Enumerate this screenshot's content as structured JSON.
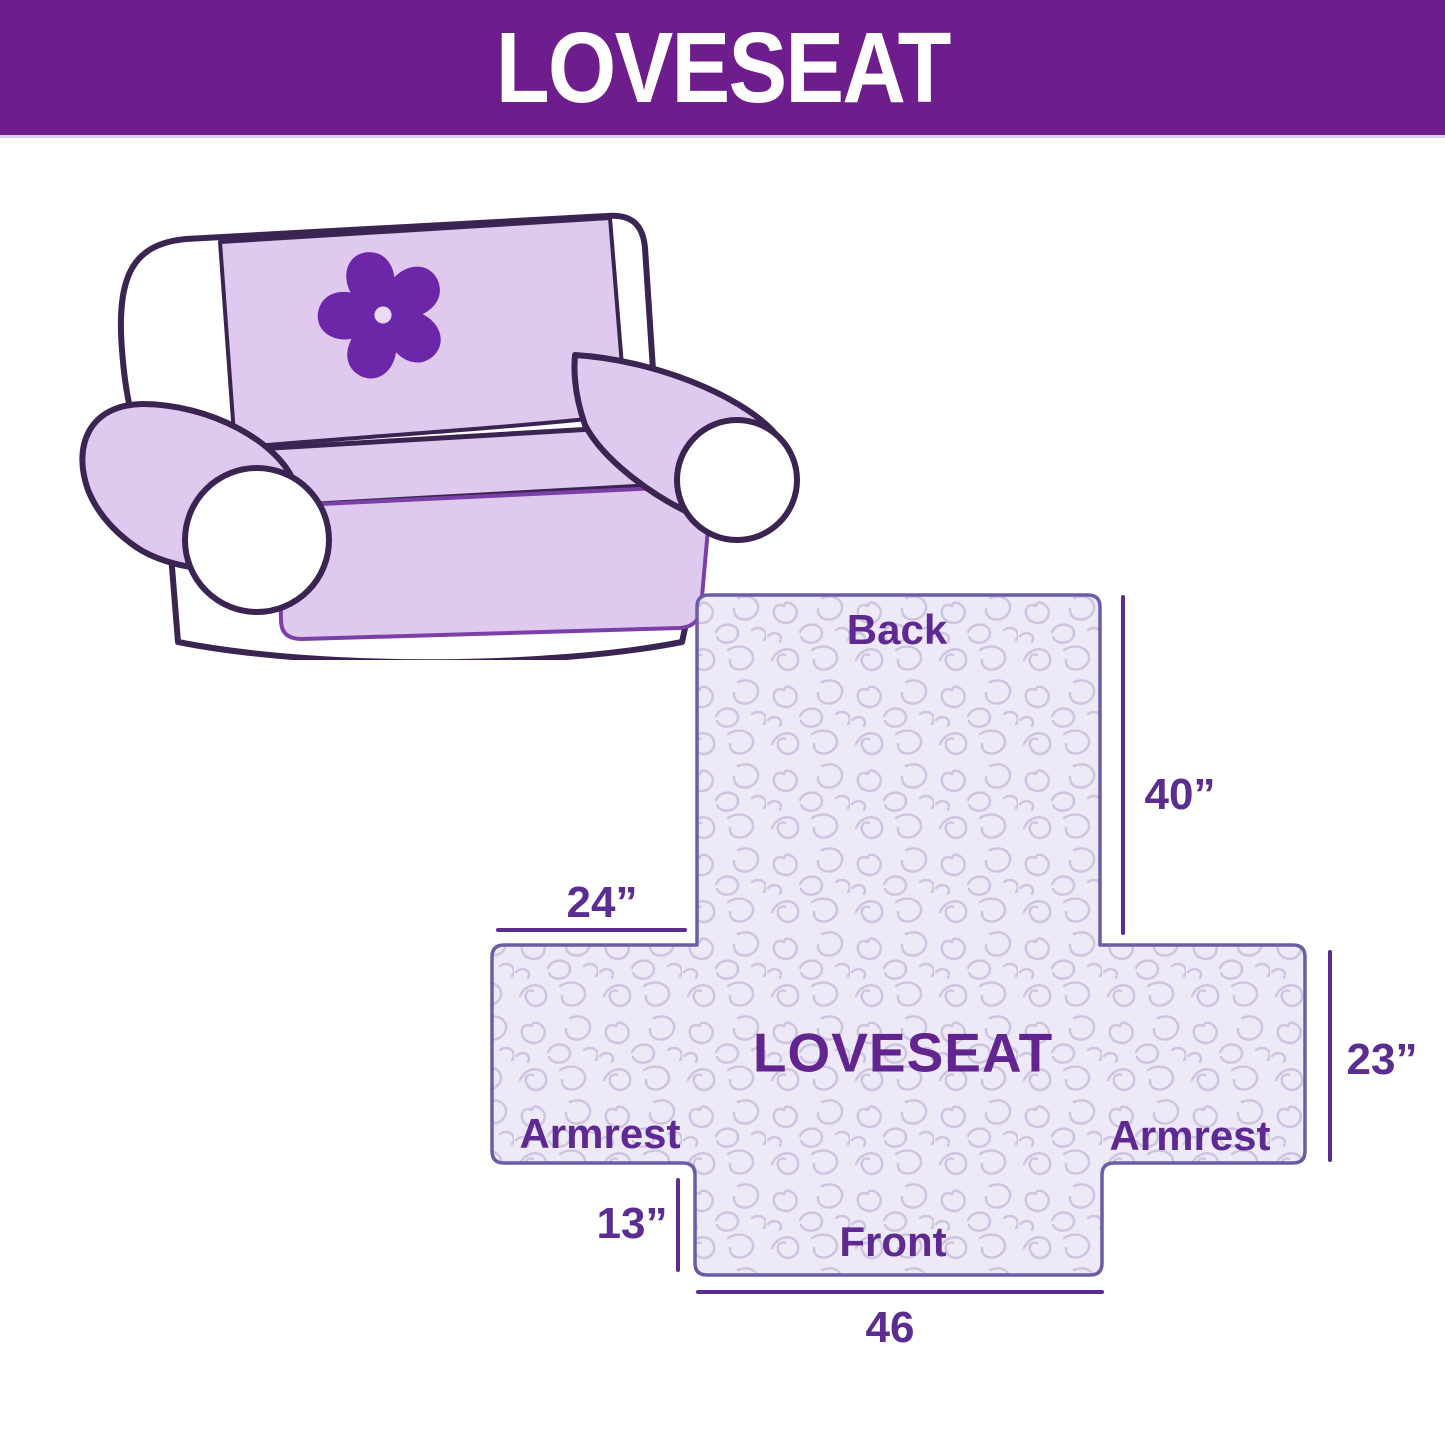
{
  "header": {
    "title": "LOVESEAT",
    "bg_color": "#6E1E8C",
    "text_color": "#FFFFFF"
  },
  "illustration": {
    "description": "loveseat sofa draped with light purple furniture cover",
    "logo_icon": "pinwheel-flower-icon",
    "cover_color": "#DFC9EE",
    "outline_color": "#3B2352",
    "logo_color": "#6C26A8"
  },
  "diagram": {
    "labels": {
      "back": "Back",
      "front": "Front",
      "armrest_left": "Armrest",
      "armrest_right": "Armrest",
      "product": "LOVESEAT"
    },
    "dimensions": {
      "back_height": "40”",
      "back_top_width": "24”",
      "armrest_height": "23”",
      "front_height": "13”",
      "front_width": "46"
    },
    "fabric_color": "#EDE9F6",
    "stitch_color": "#CDC4E1",
    "outline_color": "#6B5CA5",
    "dim_color": "#5C2D91",
    "label_color": "#5E2A91"
  }
}
